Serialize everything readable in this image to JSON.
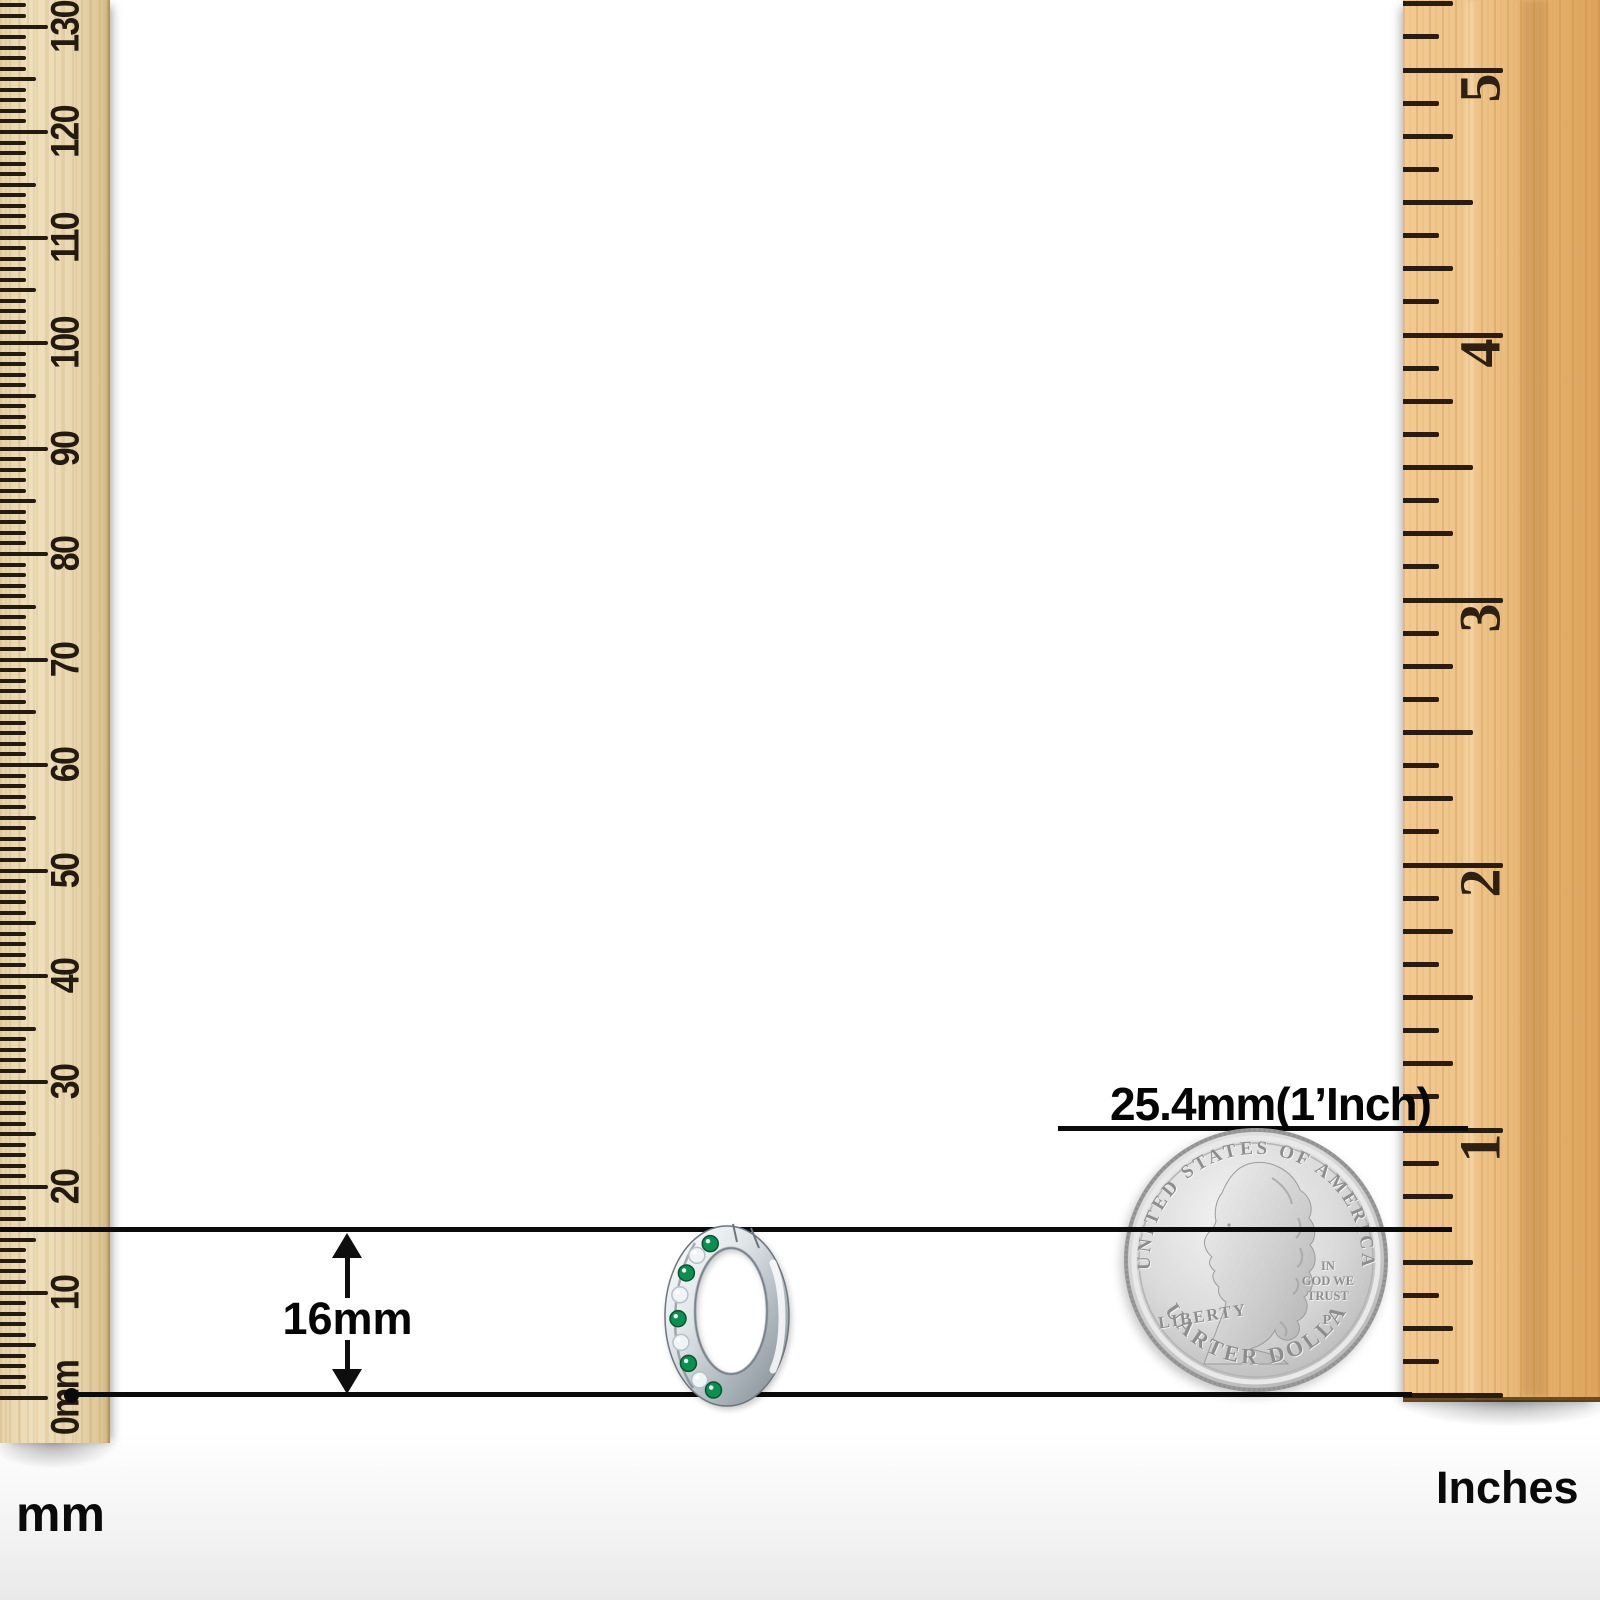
{
  "annotations": {
    "size_label": "16mm",
    "inch_reference_label": "25.4mm(1’Inch)",
    "left_unit_label": "mm",
    "right_unit_label": "Inches"
  },
  "mm_ruler": {
    "unit": "mm",
    "numbers": [
      "0mm",
      "10",
      "20",
      "30",
      "40",
      "50",
      "60",
      "70",
      "80",
      "90",
      "100",
      "110",
      "120",
      "130"
    ]
  },
  "inch_ruler": {
    "unit": "Inches",
    "numbers": [
      "1",
      "2",
      "3",
      "4",
      "5"
    ]
  },
  "coin": {
    "type": "us-quarter",
    "top_legend": "UNITED STATES OF AMERICA",
    "left_legend": "LIBERTY",
    "motto": [
      "IN",
      "GOD WE",
      "TRUST"
    ],
    "mint_mark": "P",
    "bottom_legend": "QUARTER DOLLAR"
  },
  "earring": {
    "type": "hoop-earring-16mm",
    "stones": [
      "emerald",
      "crystal",
      "emerald",
      "crystal",
      "emerald",
      "crystal",
      "emerald",
      "crystal",
      "emerald"
    ]
  },
  "colors": {
    "emerald": "#0d8f4f",
    "emerald_edge": "#065531",
    "crystal": "#eff4f6",
    "crystal_edge": "#b6c0c6",
    "tick": "#241a10",
    "line": "#0b0b0b",
    "mm_wood": "#e9d7b0",
    "inch_wood": "#eec287",
    "coin_silver": "#d6d6d6"
  }
}
